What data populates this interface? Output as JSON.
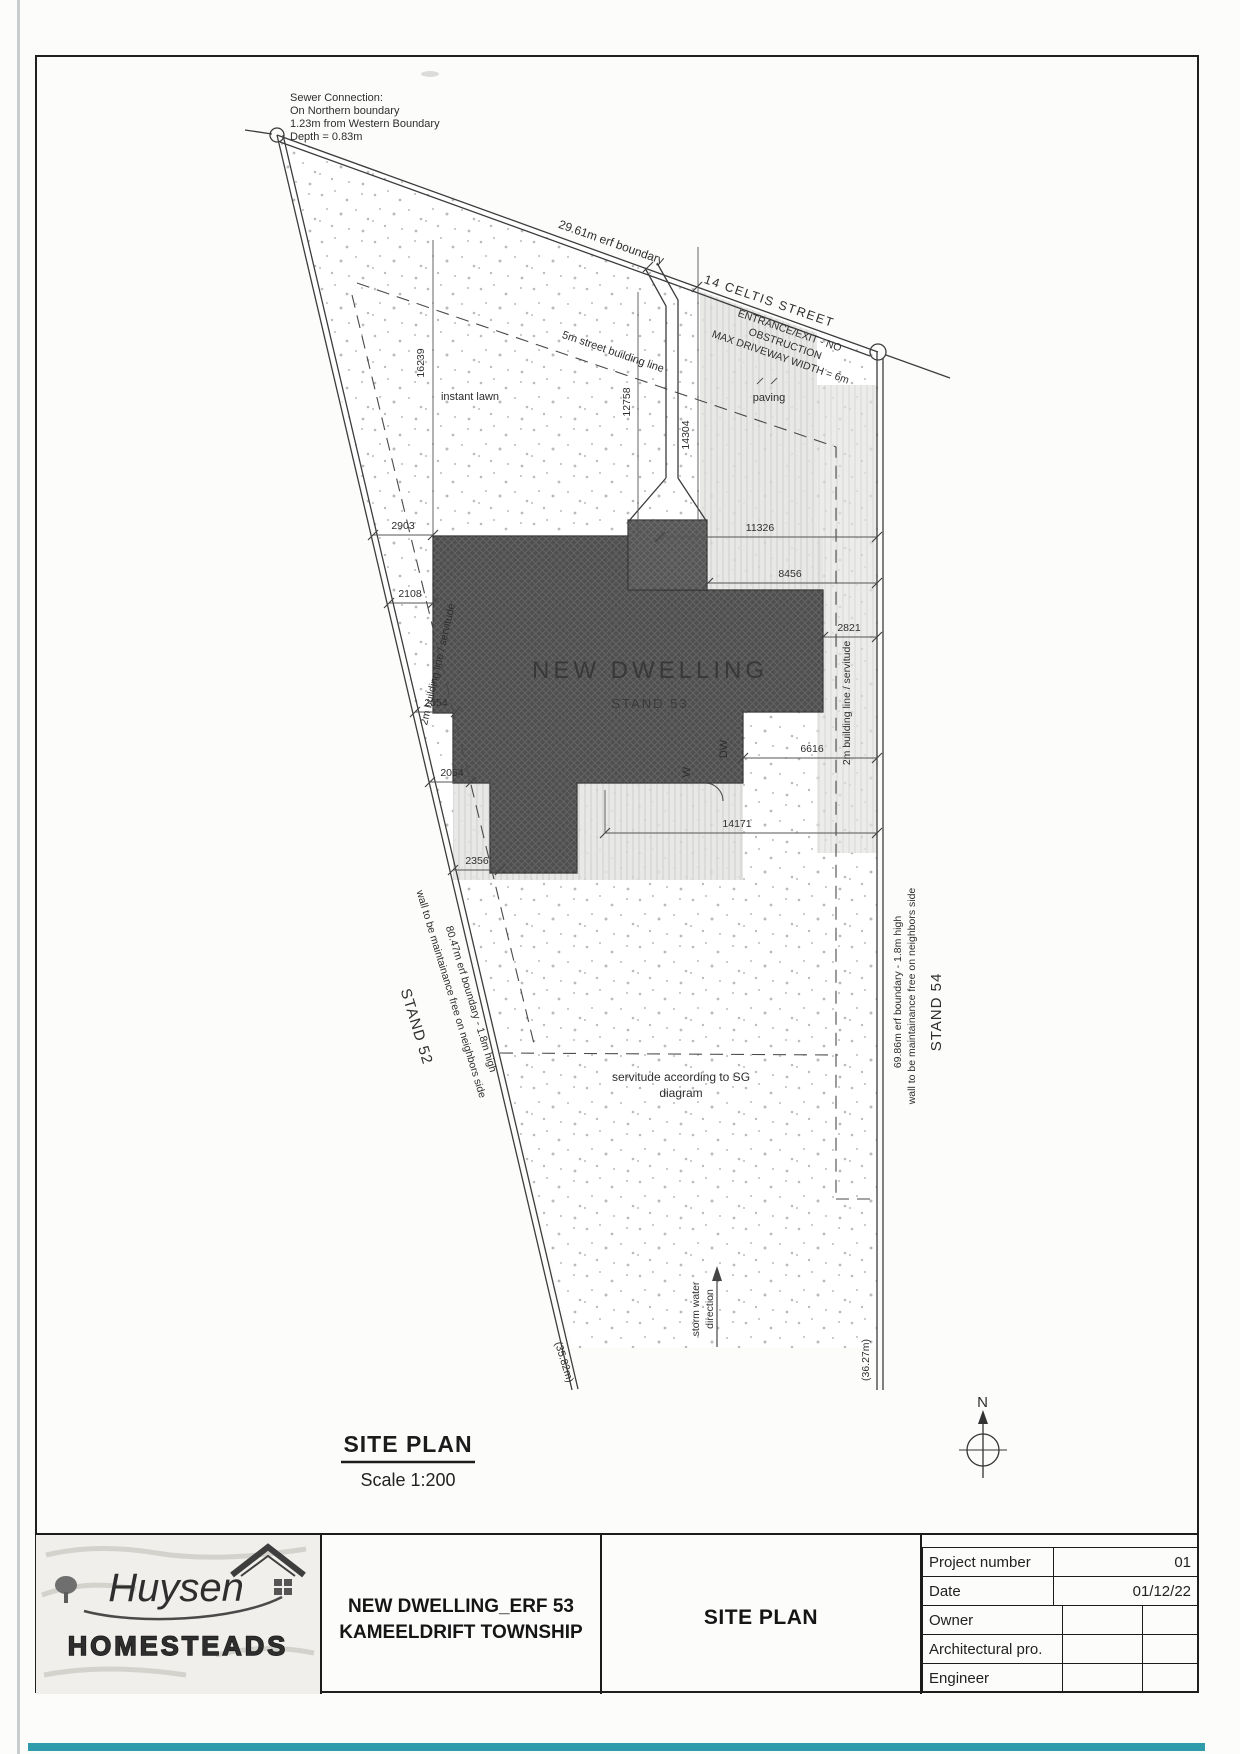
{
  "plan": {
    "notes": {
      "sewer": [
        "Sewer Connection:",
        "On Northern boundary",
        "1.23m from Western Boundary",
        "Depth = 0.83m"
      ],
      "entrance": [
        "ENTRANCE/EXIT - NO",
        "OBSTRUCTION",
        "MAX DRIVEWAY WIDTH = 6m"
      ],
      "servitude": [
        "servitude according to SG",
        "diagram"
      ],
      "storm": [
        "storm water",
        "direction"
      ]
    },
    "boundaries": {
      "north": "29.61m erf boundary",
      "street": "14 CELTIS STREET",
      "west": [
        "80.47m erf boundary - 1.8m high",
        "wall to be maintainance free on neighbors side"
      ],
      "east": [
        "69.86m erf boundary - 1.8m high",
        "wall to be maintainance free on neighbors side"
      ],
      "west_length": "(35.82m)",
      "east_length": "(36.27m)"
    },
    "building_lines": {
      "street": "5m street building line",
      "west": "2m building line / servitude",
      "east": "2m building line / servitude"
    },
    "stands": {
      "west": "STAND 52",
      "east": "STAND 54"
    },
    "areas": {
      "lawn": "instant lawn",
      "paving": "paving"
    },
    "dwelling": {
      "line1": "NEW DWELLING",
      "line2": "STAND 53"
    },
    "door_labels": {
      "w": "W",
      "dw": "DW"
    },
    "dimensions": {
      "w2903": "2903",
      "w2108": "2108",
      "w2054a": "2054",
      "w2054b": "2054",
      "w2356": "2356",
      "v16239": "16239",
      "v12758": "12758",
      "v14304": "14304",
      "e11326": "11326",
      "e8456": "8456",
      "e2821": "2821",
      "e6616": "6616",
      "e14171": "14171"
    },
    "heading": {
      "title": "SITE PLAN",
      "scale": "Scale 1:200"
    },
    "north": "N"
  },
  "title_block": {
    "logo": {
      "script": "Huysen",
      "caps": "HOMESTEADS"
    },
    "project": [
      "NEW DWELLING_ERF 53",
      "KAMEELDRIFT TOWNSHIP"
    ],
    "sheet_title": "SITE PLAN",
    "fields": [
      {
        "label": "Project number",
        "value": "01"
      },
      {
        "label": "Date",
        "value": "01/12/22"
      },
      {
        "label": "Owner",
        "value": ""
      },
      {
        "label": "Architectural pro.",
        "value": ""
      },
      {
        "label": "Engineer",
        "value": ""
      }
    ]
  }
}
